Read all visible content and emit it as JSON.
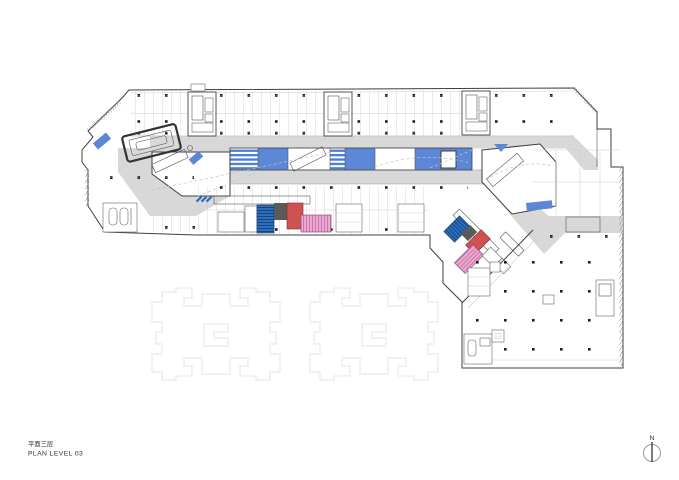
{
  "title": {
    "line1": "平面三层",
    "line2": "PLAN LEVEL 03"
  },
  "north": {
    "label": "N"
  },
  "colors": {
    "outline_dark": "#3f3f3f",
    "corridor_gray": "#d8d8d8",
    "atrium_blue": "#5b87d6",
    "stripe_blue": "#4a7ed2",
    "shopline_gray": "#c2c2c2",
    "column_black": "#1f1f1f",
    "highlight_red": "#cd5250",
    "highlight_pink": "#ecaad0",
    "highlight_pink_hatch": "#bd6ba2",
    "highlight_navy": "#2a6fc0",
    "block_gray": "#5a5a5a",
    "ghost_gray": "#ebebeb",
    "text_dark": "#2e2e2e"
  }
}
